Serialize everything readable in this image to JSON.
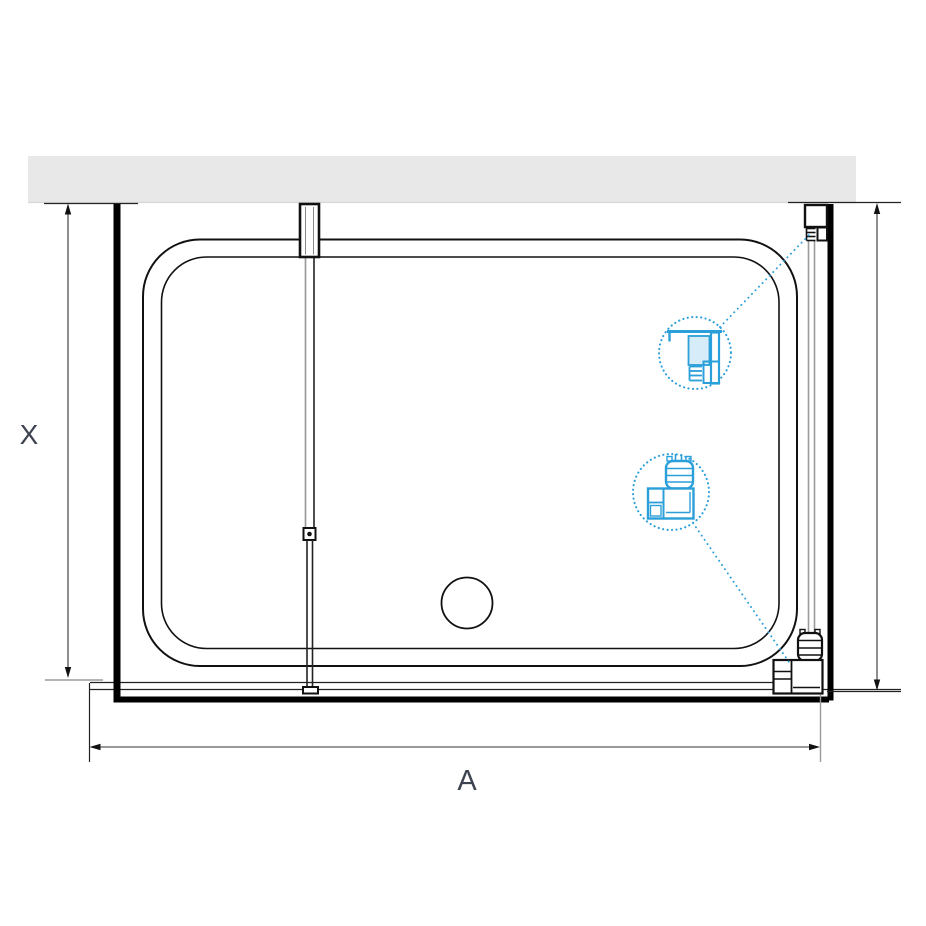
{
  "diagram": {
    "type": "shower-enclosure-top-plan-view",
    "dimension_labels": {
      "depth": "X",
      "width": "A"
    },
    "colors": {
      "accent_blue": "#2B9FD9",
      "accent_blue_light": "#D6ECF8",
      "wall_fill": "#E8E8E8",
      "wall_edge": "#D8D8D8",
      "line_black": "#111111",
      "glass_gray": "#9B9B9B",
      "dimension_line": "#333333",
      "label_text": "#3D4350"
    },
    "components": [
      "wall",
      "shower-tray",
      "drain",
      "center-glass-panel",
      "wall-mount-bracket",
      "panel-connector",
      "panel-foot",
      "right-glass-panel",
      "wall-profile",
      "corner-connector",
      "wall-profile-detail-callout",
      "corner-connector-detail-callout"
    ]
  }
}
